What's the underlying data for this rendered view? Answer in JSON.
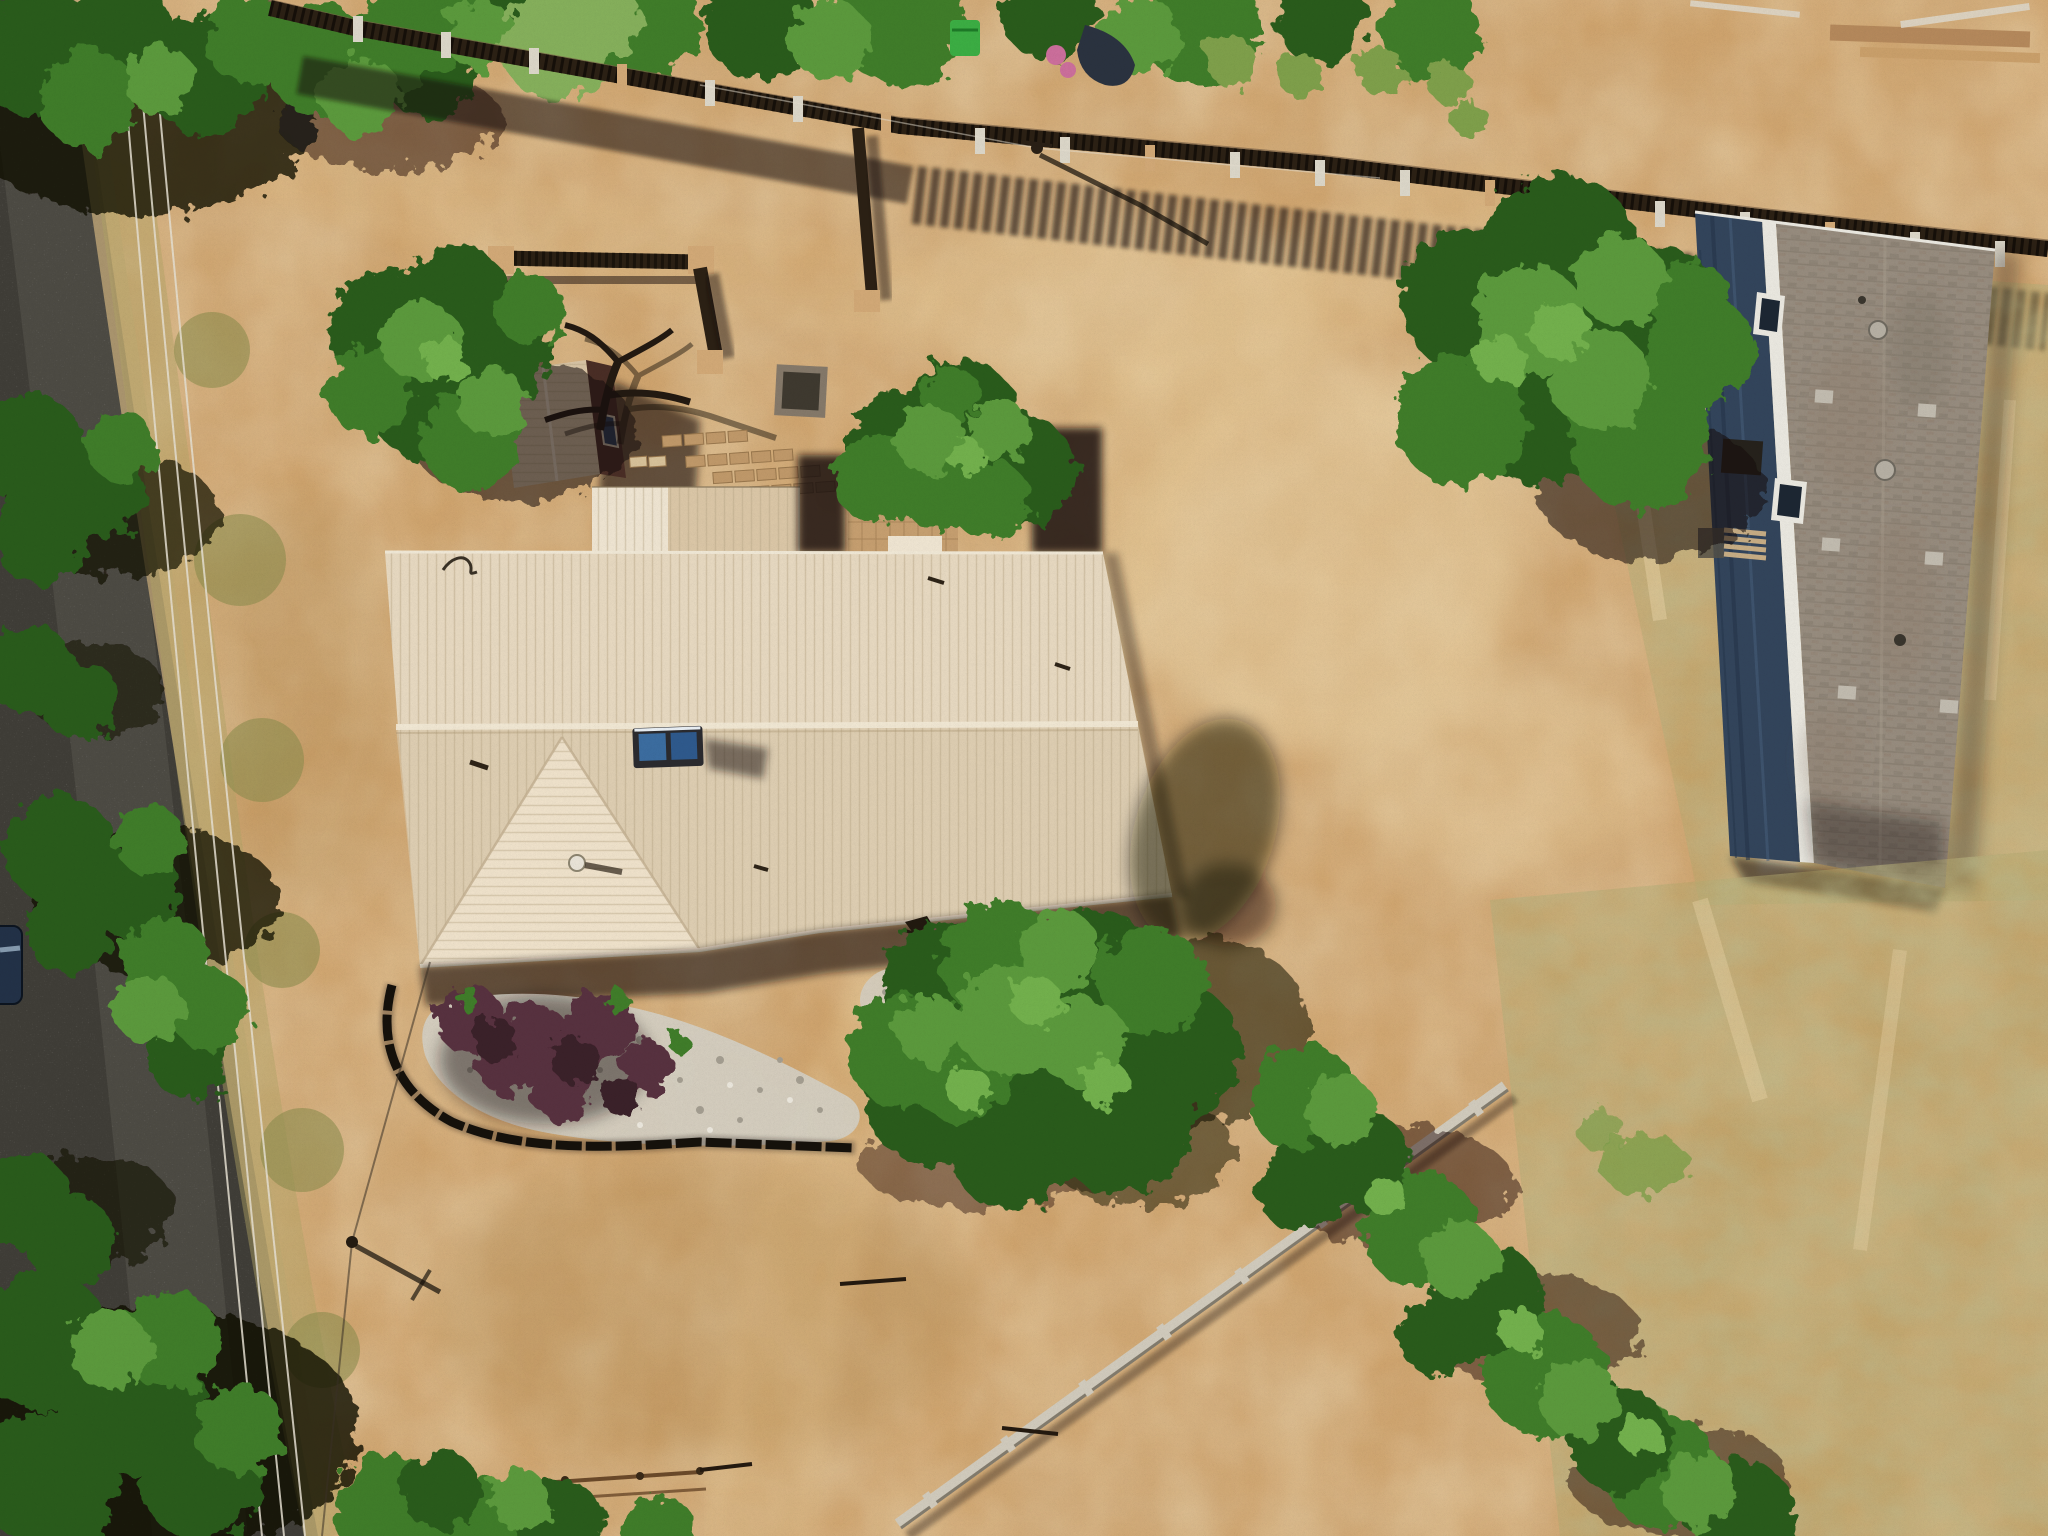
{
  "scene": {
    "type": "aerial-drone-photograph",
    "view": "top-down of rural residential property",
    "lighting": "bright midday sun, shadows cast to the southeast",
    "features": {
      "road": {
        "position": "left edge running north-south",
        "surface": "dark asphalt",
        "power_lines": 3,
        "parked_vehicle": "dark blue, partially cropped at left edge"
      },
      "main_house": {
        "roof": "cream standing-seam metal, east-west ridge",
        "wing": "south-projecting hip roof",
        "rooftop_items": [
          "dual blue skylight unit on ridge",
          "white round vent",
          "small pipe vents",
          "antenna wire"
        ]
      },
      "courtyard": [
        "dark wood coyote-fence walls with tan adobe posts",
        "small shed with tan gable roof and maroon wall",
        "dead juniper branch sculpture",
        "square weathered planter box",
        "brick paver steps",
        "brick patio under shade tree"
      ],
      "garden_bed": [
        "curved black metal edging",
        "white river rock mulch",
        "maroon shrubs"
      ],
      "neighbor_house": {
        "siding": "navy blue",
        "roof": "gray-brown asphalt shingle",
        "details": [
          "white window frames",
          "square roof vents",
          "round vents",
          "AC unit",
          "wood steps/deck"
        ]
      },
      "fences": [
        "dark wood picket fence with concrete posts along north boundary",
        "light gray fence running toward southeast corner"
      ],
      "vegetation": [
        "trees overhanging road",
        "shade tree in courtyard",
        "large tree northeast of house",
        "large tree south of house",
        "large tree west of neighbor house",
        "bush row along southeast fence",
        "dry grass verge"
      ],
      "ground": "bare tan dirt yard with tire tracks and dry grass patches",
      "misc": [
        "green trash bin behind fence",
        "pink objects behind fence",
        "wood boards at top right",
        "utility pole with long shadow",
        "pole crossarm shadow lower left",
        "scattered sticks",
        "low wood rail at bottom"
      ]
    }
  },
  "palette": {
    "dirt_base": "#cfa46e",
    "dirt_light": "#e3c492",
    "dirt_dark": "#b0884f",
    "dirt_pale": "#ecd5a8",
    "grass_khaki": "#b2a567",
    "grass_olive": "#8e8d4f",
    "grass_bright": "#7fa04b",
    "road_asphalt": "#403e38",
    "road_worn": "#6e6a60",
    "gravel": "#c9ad7c",
    "shadow": "#120e08",
    "wire": "#e6e0d2",
    "tree_dark": "#2b5b1e",
    "tree_mid": "#3f7d2a",
    "tree_light": "#5b9a3c",
    "tree_bright": "#73b14d",
    "willow": "#86b05b",
    "fence_wood": "#2c2115",
    "fence_hl": "#7a6348",
    "post_concrete": "#dcd7c9",
    "post_tan": "#d2a977",
    "bin_green": "#3cae44",
    "pink_items": "#cc6f9c",
    "tarp_navy": "#2b3340",
    "wood_pile": "#b5895c",
    "board_light": "#dcd2c0",
    "roof_cream": "#e7d9c1",
    "roof_south": "#d9c7ab",
    "roof_bright": "#efe2cb",
    "roof_rib": "#b9a686",
    "roof_ridge": "#f3ead7",
    "awning_white": "#efe5d2",
    "awning_tan": "#dbc7a7",
    "shed_roof": "#d8c4a5",
    "shed_wall": "#4a2e26",
    "glass_dark": "#2c3d58",
    "brick": "#c0996a",
    "brick_line": "#9a784e",
    "brick_court": "#c49d6f",
    "planter_wood": "#85796a",
    "rock_light": "#d4cfc3",
    "rock_shade": "#a49e91",
    "shrub": "#59303f",
    "shrub_dark": "#3a2029",
    "edging": "#16120c",
    "sky_frame": "#2b2b2f",
    "sky_glass1": "#3c6da0",
    "sky_glass2": "#2f5a8d",
    "glare": "#e9eff4",
    "nb_wall": "#33455c",
    "nb_wall_dark": "#26354a",
    "nb_wall_light": "#49617e",
    "nb_trim": "#eae8e0",
    "nb_roof": "#978c7e",
    "nb_roof_dark": "#7c7163",
    "nb_roof_warm": "#8f7e6c",
    "vent_gray": "#c2bcb0",
    "deck_wood": "#c7ad85",
    "bfence": "#d1cbbd",
    "bfence_dark": "#837c6e",
    "car_blue": "#233248",
    "rail_brown": "#6b4a2a"
  }
}
